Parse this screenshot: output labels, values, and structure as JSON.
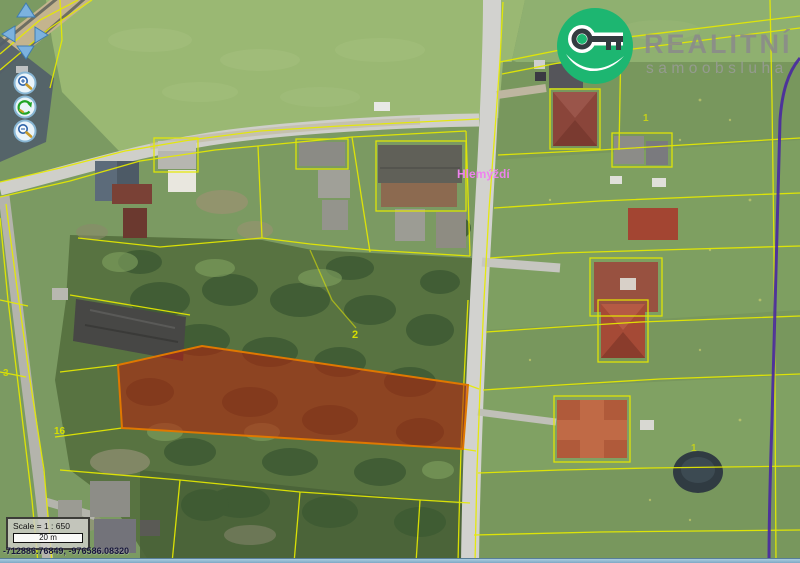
{
  "app": {
    "name": "cadastral map viewer"
  },
  "logo": {
    "title": "REALITNÍ",
    "subtitle": "samoobsluha",
    "icon": "key-icon",
    "brand_green": "#1db671",
    "text_gray": "#8b8b8b"
  },
  "controls": {
    "pan": [
      "up",
      "left",
      "right",
      "down"
    ],
    "buttons": [
      "zoom-in",
      "refresh",
      "zoom-out"
    ]
  },
  "map": {
    "place_label": {
      "text": "Hlemýždí",
      "color": "#ee82ee"
    },
    "highlighted_parcel": {
      "fill": "#b91e0a",
      "stroke": "#e07800",
      "fill_opacity": 0.55
    },
    "parcel_numbers": [
      {
        "text": "2"
      },
      {
        "text": "16"
      },
      {
        "text": "1"
      },
      {
        "text": "1"
      },
      {
        "text": "3"
      }
    ],
    "cadastral_line_color": "#e6ea00",
    "district_line_color": "#4a2aa0"
  },
  "scale_box": {
    "scale_text": "Scale = 1 : 650",
    "bar_label": "20 m"
  },
  "status_bar": {
    "coordinates": "-712886.76849, -976586.08320"
  }
}
